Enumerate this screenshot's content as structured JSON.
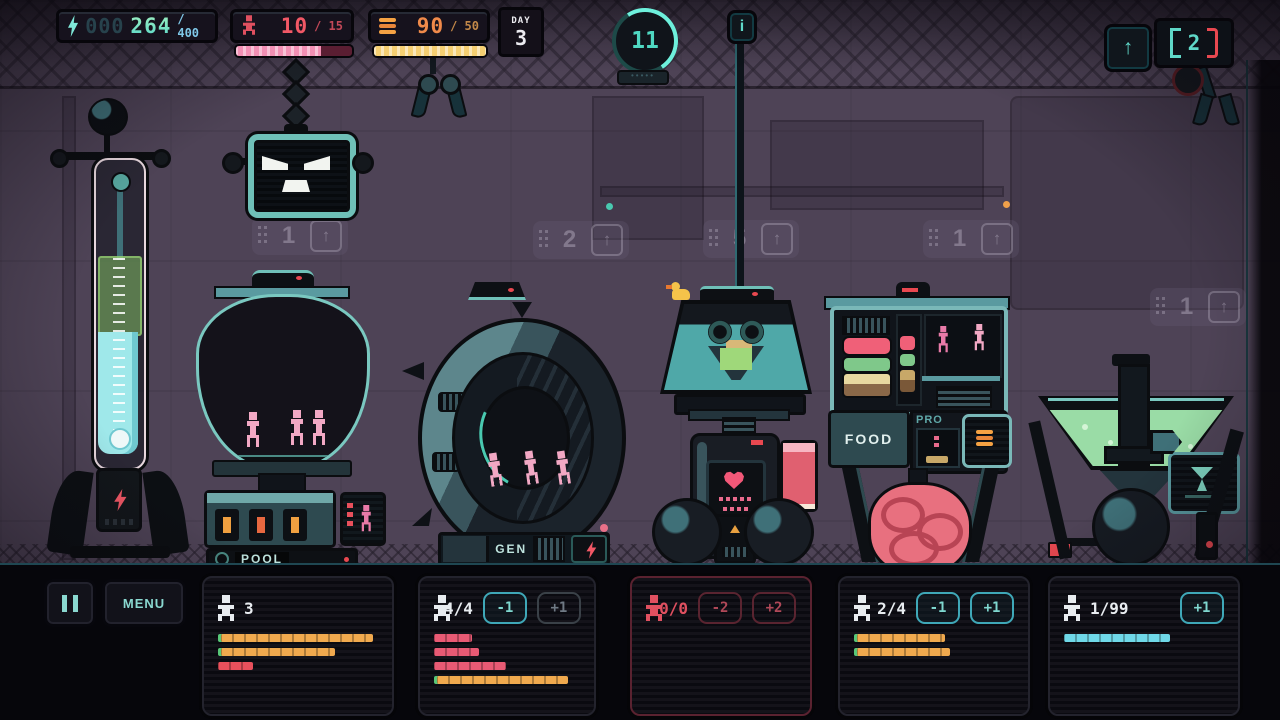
{
  "hud": {
    "energy": {
      "icon": "lightning",
      "pad": "000",
      "value": "264",
      "max": "/ 400"
    },
    "population": {
      "icon": "person",
      "value": "10",
      "max": "/ 15",
      "bar_pct": 73
    },
    "food": {
      "icon": "burger",
      "value": "90",
      "max": "/ 50",
      "bar_pct": 100
    },
    "day": {
      "label": "DAY",
      "value": "3"
    },
    "badge": {
      "value": "11",
      "stars": "•••••"
    },
    "info_label": "i",
    "upgrade_arrow": "↑",
    "claw_counter": {
      "value": "2"
    }
  },
  "background": {
    "arrow_glyph": "↑",
    "markers": [
      {
        "value": "1"
      },
      {
        "value": "2"
      },
      {
        "value": "5"
      },
      {
        "value": "1"
      },
      {
        "value": "1"
      }
    ]
  },
  "machines": {
    "pool_label": "POOL",
    "gen_label": "GEN",
    "rep_label": "REP",
    "food_label": "FOOD",
    "pro_label": "PRO"
  },
  "bottom": {
    "menu_label": "MENU",
    "panels": [
      {
        "icon_color": "white",
        "count": "3",
        "buttons": [],
        "bars": [
          {
            "color": "orange",
            "pct": 95
          },
          {
            "color": "orange",
            "pct": 71
          },
          {
            "color": "red",
            "pct": 22
          }
        ]
      },
      {
        "icon_color": "white",
        "count": "4/4",
        "buttons": [
          {
            "label": "-1",
            "state": "active"
          },
          {
            "label": "+1",
            "state": "dim"
          }
        ],
        "bars": [
          {
            "color": "pink",
            "pct": 26
          },
          {
            "color": "pink",
            "pct": 31
          },
          {
            "color": "pink",
            "pct": 49
          },
          {
            "color": "orange",
            "pct": 90
          }
        ]
      },
      {
        "icon_color": "red",
        "count": "0/0",
        "accent": "red",
        "buttons": [
          {
            "label": "-2",
            "state": "dim-red"
          },
          {
            "label": "+2",
            "state": "dim-red"
          }
        ],
        "bars": []
      },
      {
        "icon_color": "white",
        "count": "2/4",
        "buttons": [
          {
            "label": "-1",
            "state": "active"
          },
          {
            "label": "+1",
            "state": "active"
          }
        ],
        "bars": [
          {
            "color": "orange",
            "pct": 55
          },
          {
            "color": "orange",
            "pct": 58
          }
        ]
      },
      {
        "icon_color": "white",
        "count": "1/99",
        "buttons": [
          {
            "label": "+1",
            "state": "active"
          }
        ],
        "bars": [
          {
            "color": "cyan",
            "pct": 66
          }
        ]
      }
    ]
  }
}
